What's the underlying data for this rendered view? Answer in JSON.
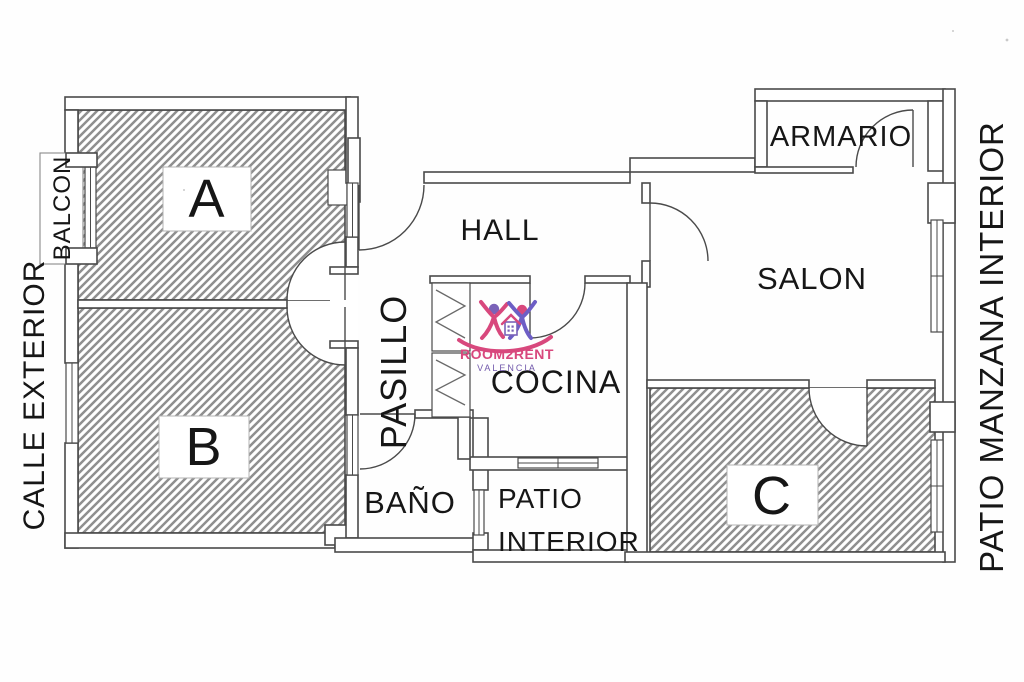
{
  "plan": {
    "rooms": {
      "a": "A",
      "b": "B",
      "c": "C",
      "hall": "HALL",
      "salon": "SALON",
      "cocina": "COCINA",
      "pasillo": "PASILLO",
      "bano": "BAÑO",
      "armario": "ARMARIO",
      "balcon": "BALCON",
      "patio_line1": "PATIO",
      "patio_line2": "INTERIOR"
    },
    "surroundings": {
      "left_street": "CALLE EXTERIOR",
      "right_patio": "PATIO MANZANA INTERIOR"
    }
  },
  "logo": {
    "brand": "ROOM2RENT",
    "city": "VALENCIA"
  },
  "colors": {
    "brand_pink": "#d8487d",
    "brand_purple": "#7158ab",
    "head_purple": "#7a62b8",
    "body_purple": "#6d5ec5",
    "hatch_gray": "#8f8f8f",
    "wall_gray": "#4a4a4a",
    "ink": "#161616"
  }
}
